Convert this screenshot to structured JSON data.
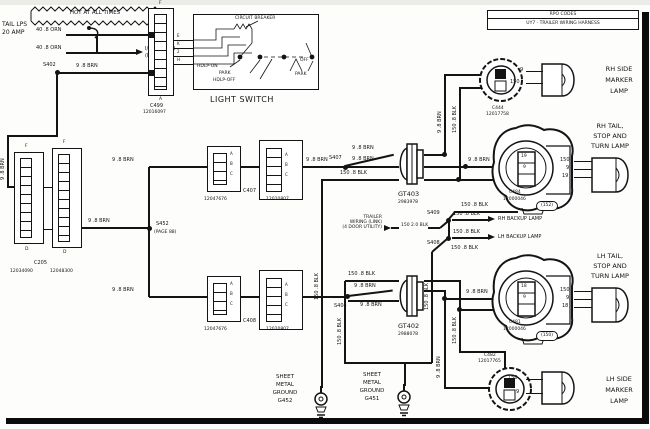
{
  "power": {
    "hot": "HOT AT ALL TIMES",
    "fuse_name": "TAIL LPS",
    "fuse_rating": "20 AMP",
    "wire_feed": "40 .8 ORN",
    "wire_cluster": "40 .8 ORN",
    "cluster_1": "I/P CLUSTER",
    "cluster_2": "(PAGE 110)",
    "splice": "S402",
    "wire_park": "9 .8 BRN",
    "wire_drop": "9 .8 BRN"
  },
  "c499": {
    "name": "C499",
    "part": "12016097",
    "idx_top": "F",
    "idx_bottom": "A",
    "pins": [
      "E",
      "K",
      "2",
      "H"
    ]
  },
  "light_switch": {
    "title": "LIGHT SWITCH",
    "breaker": "CIRCUIT BREAKER",
    "hdlp_on": "HDLP-ON",
    "park_l": "PARK",
    "hdlp_off": "HDLP-OFF",
    "off": "OFF",
    "park_r": "PARK"
  },
  "rpo": {
    "header": "RPO CODES",
    "code": "UY7 - TRAILER WIRING HARNESS"
  },
  "c205": {
    "name": "C205",
    "part_l": "12034090",
    "part_r": "12048300",
    "f1": "F",
    "d1": "D",
    "f2": "F",
    "d2": "D",
    "wire_out": "9 .8 BRN"
  },
  "s452": {
    "name": "S452",
    "page": "(PAGE 88)",
    "wire_c407": "9 .8 BRN",
    "wire_c408": "9 .8 BRN"
  },
  "c407": {
    "name": "C407",
    "part_l": "12047676",
    "part_r": "12020807",
    "pins": [
      "A",
      "B",
      "C"
    ],
    "wire_out": "9 .8 BRN"
  },
  "c408": {
    "name": "C408",
    "part_l": "12047676",
    "part_r": "12020807",
    "pins": [
      "A",
      "B",
      "C"
    ]
  },
  "gt403": {
    "name": "GT403",
    "part": "2983978",
    "splice": "S407",
    "w_top": "9 .8 BRN",
    "w_mid": "9 .8 BRN",
    "w_gnd": "150 .8 BLK",
    "riser_feed": "9 .8 BRN",
    "riser_gnd": "150 .8 BLK",
    "tail_feed": "9 .8 BRN"
  },
  "gt402": {
    "name": "GT402",
    "part": "2988078",
    "splice": "S404",
    "w_gnd": "150 .8 BLK",
    "w_mid": "9 .8 BRN",
    "w_bot": "9 .8 BRN",
    "riser_feed": "9 .8 BRN",
    "riser_gnd": "150 .8 BLK",
    "lamp_feed": "9 .8 BRN"
  },
  "c444": {
    "name": "C444",
    "part": "12017758"
  },
  "rh_marker": {
    "l1": "RH SIDE",
    "l2": "MARKER",
    "l3": "LAMP",
    "pin_top": "9",
    "pin_bot": "150"
  },
  "rh_tail": {
    "l1": "RH TAIL,",
    "l2": "STOP AND",
    "l3": "TURN LAMP",
    "conn": "C484",
    "part": "12000046",
    "tag": "(152)",
    "cell1": "19",
    "cell2": "9",
    "bp1": "150",
    "bp2": "9",
    "bp3": "19",
    "gnd_return": "150 .8 BLK"
  },
  "splices": {
    "s409": "S409",
    "s408": "S408",
    "w_rh": "150 .8 BLK",
    "w_lh": "150 .8 BLK",
    "rh_text": "RH BACKUP LAMP",
    "lh_text": "LH BACKUP LAMP",
    "w_down": "150 .8 BLK"
  },
  "trailer": {
    "l1": "TRAILER",
    "l2": "WIRING (LINK)",
    "l3": "(4 DOOR UTILITY)",
    "wire": "150 2.0 BLK"
  },
  "lh_tail": {
    "l1": "LH TAIL,",
    "l2": "STOP AND",
    "l3": "TURN LAMP",
    "conn": "C481",
    "part": "12000046",
    "tag": "(150)",
    "cell1": "18",
    "cell2": "9",
    "bp1": "150",
    "bp2": "9",
    "bp3": "18"
  },
  "c482": {
    "name": "C482",
    "part": "12017765"
  },
  "lh_marker": {
    "l1": "LH SIDE",
    "l2": "MARKER",
    "l3": "LAMP",
    "pin_top": "150",
    "pin_bot": "9"
  },
  "g452": {
    "l1": "SHEET",
    "l2": "METAL",
    "l3": "GROUND",
    "l4": "G452"
  },
  "g451": {
    "l1": "SHEET",
    "l2": "METAL",
    "l3": "GROUND",
    "l4": "G451"
  },
  "risers": {
    "chain": "150 .8 BLK"
  }
}
